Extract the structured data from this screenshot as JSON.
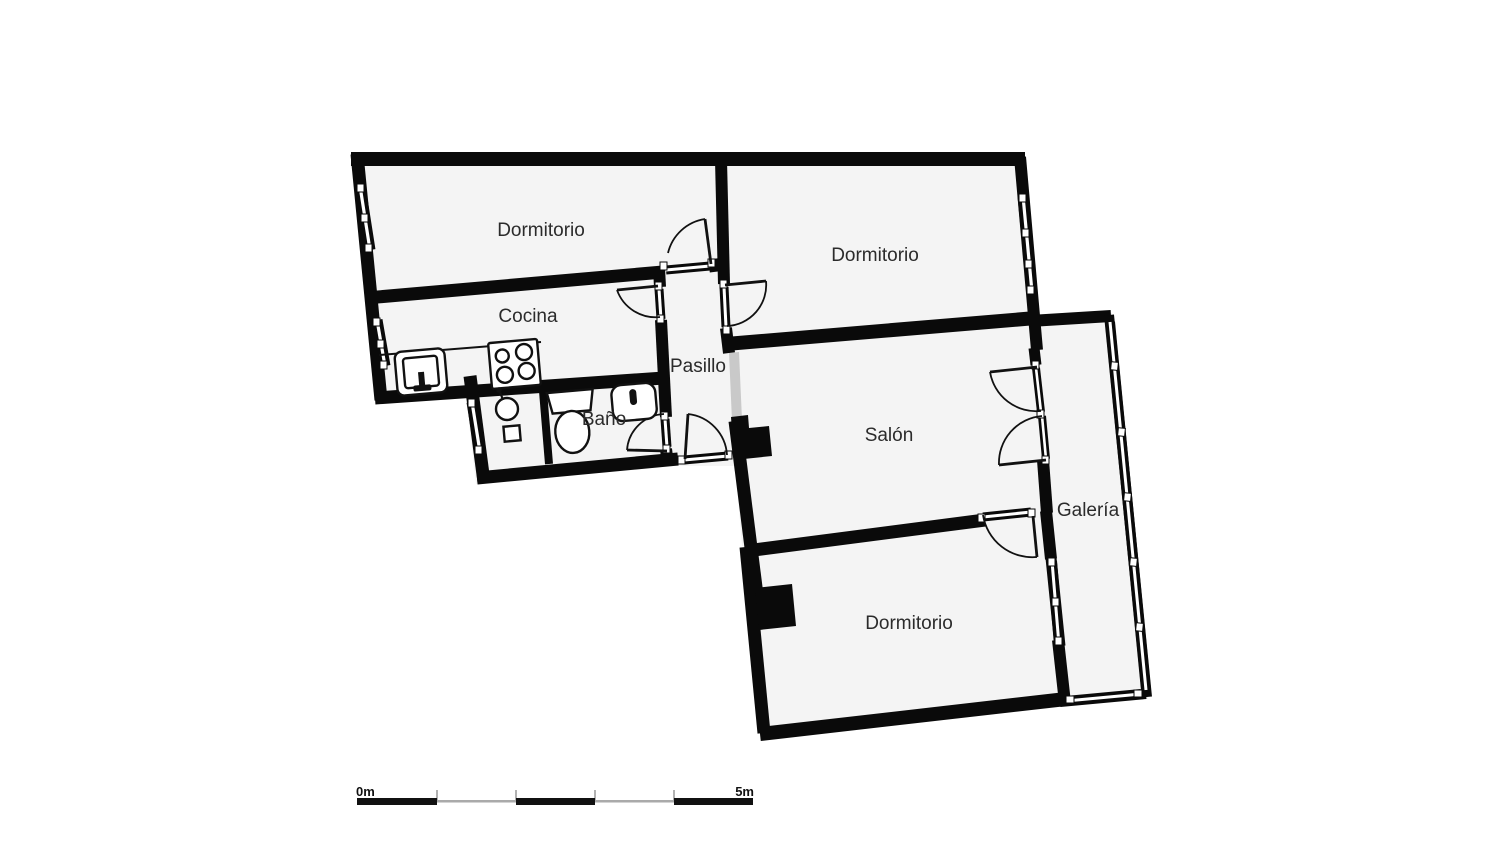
{
  "plan": {
    "title": "apartment-floor-plan",
    "rooms": [
      {
        "name": "dormitorio-top-left",
        "label": "Dormitorio"
      },
      {
        "name": "dormitorio-top-right",
        "label": "Dormitorio"
      },
      {
        "name": "cocina",
        "label": "Cocina"
      },
      {
        "name": "pasillo",
        "label": "Pasillo"
      },
      {
        "name": "bano",
        "label": "Baño"
      },
      {
        "name": "salon",
        "label": "Salón"
      },
      {
        "name": "galeria",
        "label": "Galería"
      },
      {
        "name": "dormitorio-bottom",
        "label": "Dormitorio"
      }
    ],
    "fixtures": [
      "kitchen-sink",
      "stove-4-burners",
      "counter",
      "wash-basin",
      "floor-drain-square",
      "toilet",
      "bidet"
    ],
    "doors": [
      "dormitorio-top-left-door",
      "cocina-door",
      "dormitorio-top-right-door",
      "bano-door",
      "entrance-door",
      "salon-galeria-double-door",
      "dormitorio-bottom-door",
      "pasillo-salon-opening"
    ],
    "scale_bar": {
      "start": "0m",
      "end": "5m"
    },
    "colors": {
      "wall": "#0a0a0a",
      "floor": "#f4f4f4",
      "background": "#ffffff",
      "opening_gray": "#c9c9c9",
      "scale_thin": "#aaaaaa"
    }
  }
}
